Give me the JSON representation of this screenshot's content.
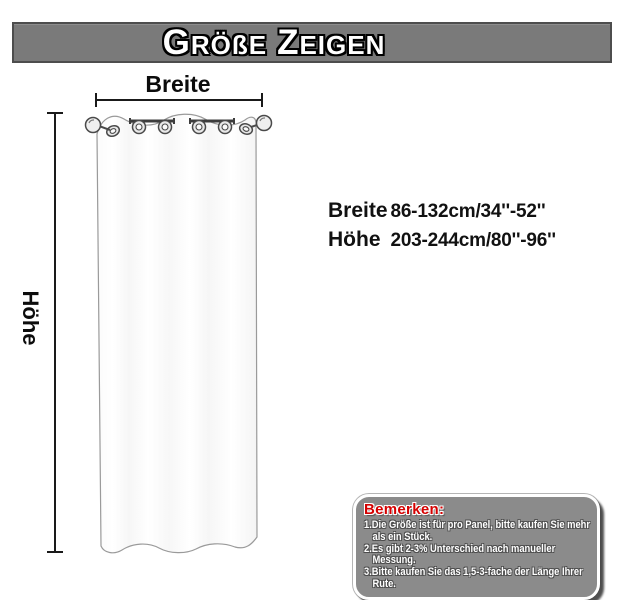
{
  "header": {
    "title": [
      {
        "initial": "G",
        "rest": "RÖßE"
      },
      {
        "initial": "Z",
        "rest": "EIGEN"
      }
    ]
  },
  "diagram": {
    "width_label": "Breite",
    "height_label": "Höhe"
  },
  "specs": {
    "rows": [
      {
        "label": "Breite",
        "value": "86-132cm/34''-52''"
      },
      {
        "label": "Höhe",
        "value": "203-244cm/80''-96''"
      }
    ]
  },
  "notes": {
    "title": "Bemerken:",
    "items": [
      [
        "1.Die Größe ist für pro Panel, bitte kaufen Sie mehr",
        "als ein Stück."
      ],
      [
        "2.Es gibt 2-3% Unterschied nach manueller",
        "Messung."
      ],
      [
        "3.Bitte kaufen Sie das 1,5-3-fache der Länge Ihrer",
        "Rute."
      ]
    ]
  },
  "colors": {
    "banner_bg": "#7a7a7a",
    "banner_border": "#4d4d4d",
    "notes_bg": "#8b8b8b",
    "notes_title": "#d40000",
    "dimension_line": "#1a1a1a",
    "curtain_outline": "#9a9a9a"
  }
}
